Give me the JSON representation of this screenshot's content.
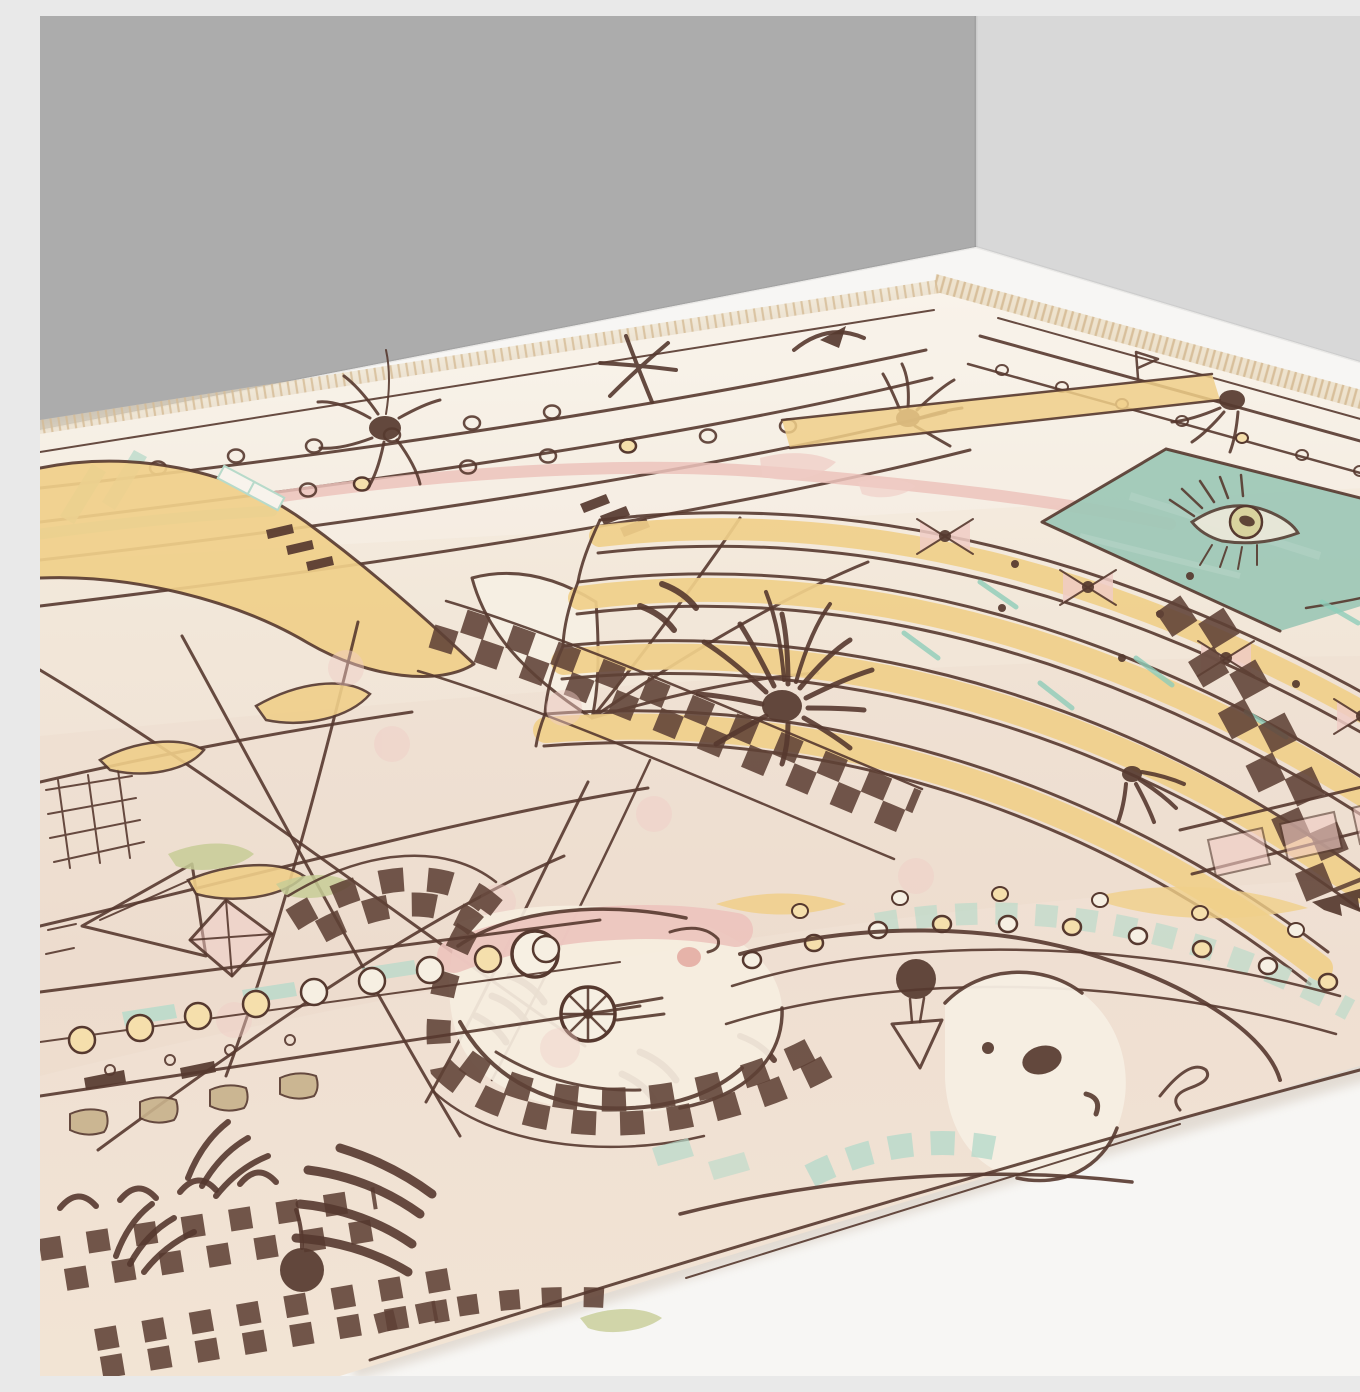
{
  "meta": {
    "title": "Abstract hand-drawn wool rug photographed in a room corner",
    "description": "Three-quarter perspective product photo: a large cream rug with playful sketched motifs in dark maroon, yellow, teal, pink and green lies on a white floor against a gray corner wall. No text appears in the image."
  },
  "colors": {
    "wall_left": "#ACACAC",
    "wall_right": "#D8D8D8",
    "floor": "#F7F6F4",
    "shadow": "#DFD7CE",
    "rug_light": "#F8F1E6",
    "rug_base": "#F2E7D9",
    "rug_mid": "#EFDFD2",
    "rug_low": "#F2E4D4",
    "fringe": "#EBDCC1",
    "fringe_strand": "#D5BB95",
    "ink": "#56392F",
    "ink_dark": "#5E4136",
    "yellow": "#F0CF8A",
    "yellow_pale": "#F5DFAC",
    "teal_rect": "#9FC8B7",
    "teal_stripe": "#B7DACA",
    "teal_bright": "#8FCDB9",
    "pink": "#F0CCC5",
    "pink_band": "#ECC3BC",
    "pink_deep": "#E4ACA3",
    "green": "#C7CD96",
    "tan": "#C8B28C",
    "olive": "#D9D39E",
    "face": "#F6EEE0",
    "ghost": "#F5EEE3",
    "cream": "#F6EFE2"
  },
  "rug": {
    "motifs": [
      "fringed-edges",
      "top-border-lines",
      "teal-wavy-stripes",
      "dotted-rows",
      "asterisk-star",
      "flying-bird",
      "spider-blobs",
      "upper-left-yellow-mass",
      "white-sail-funnel",
      "wavy-yellow-fan",
      "teal-eye-panel",
      "pink-bowtie-stars",
      "right-checker-column",
      "center-checker-band",
      "sketch-crossing-lines",
      "net-grid",
      "sail-and-kite",
      "leaf-petals",
      "green-patches",
      "radial-burst",
      "moon-face-with-wheel",
      "rainbow-checker",
      "dotted-border-band",
      "tan-blobs",
      "arch-row",
      "grass-tufts",
      "pompom-dots",
      "ghost-bird-face",
      "pompom-hat",
      "teal-checker-bands",
      "dot-arcs",
      "signature-squiggle"
    ]
  }
}
